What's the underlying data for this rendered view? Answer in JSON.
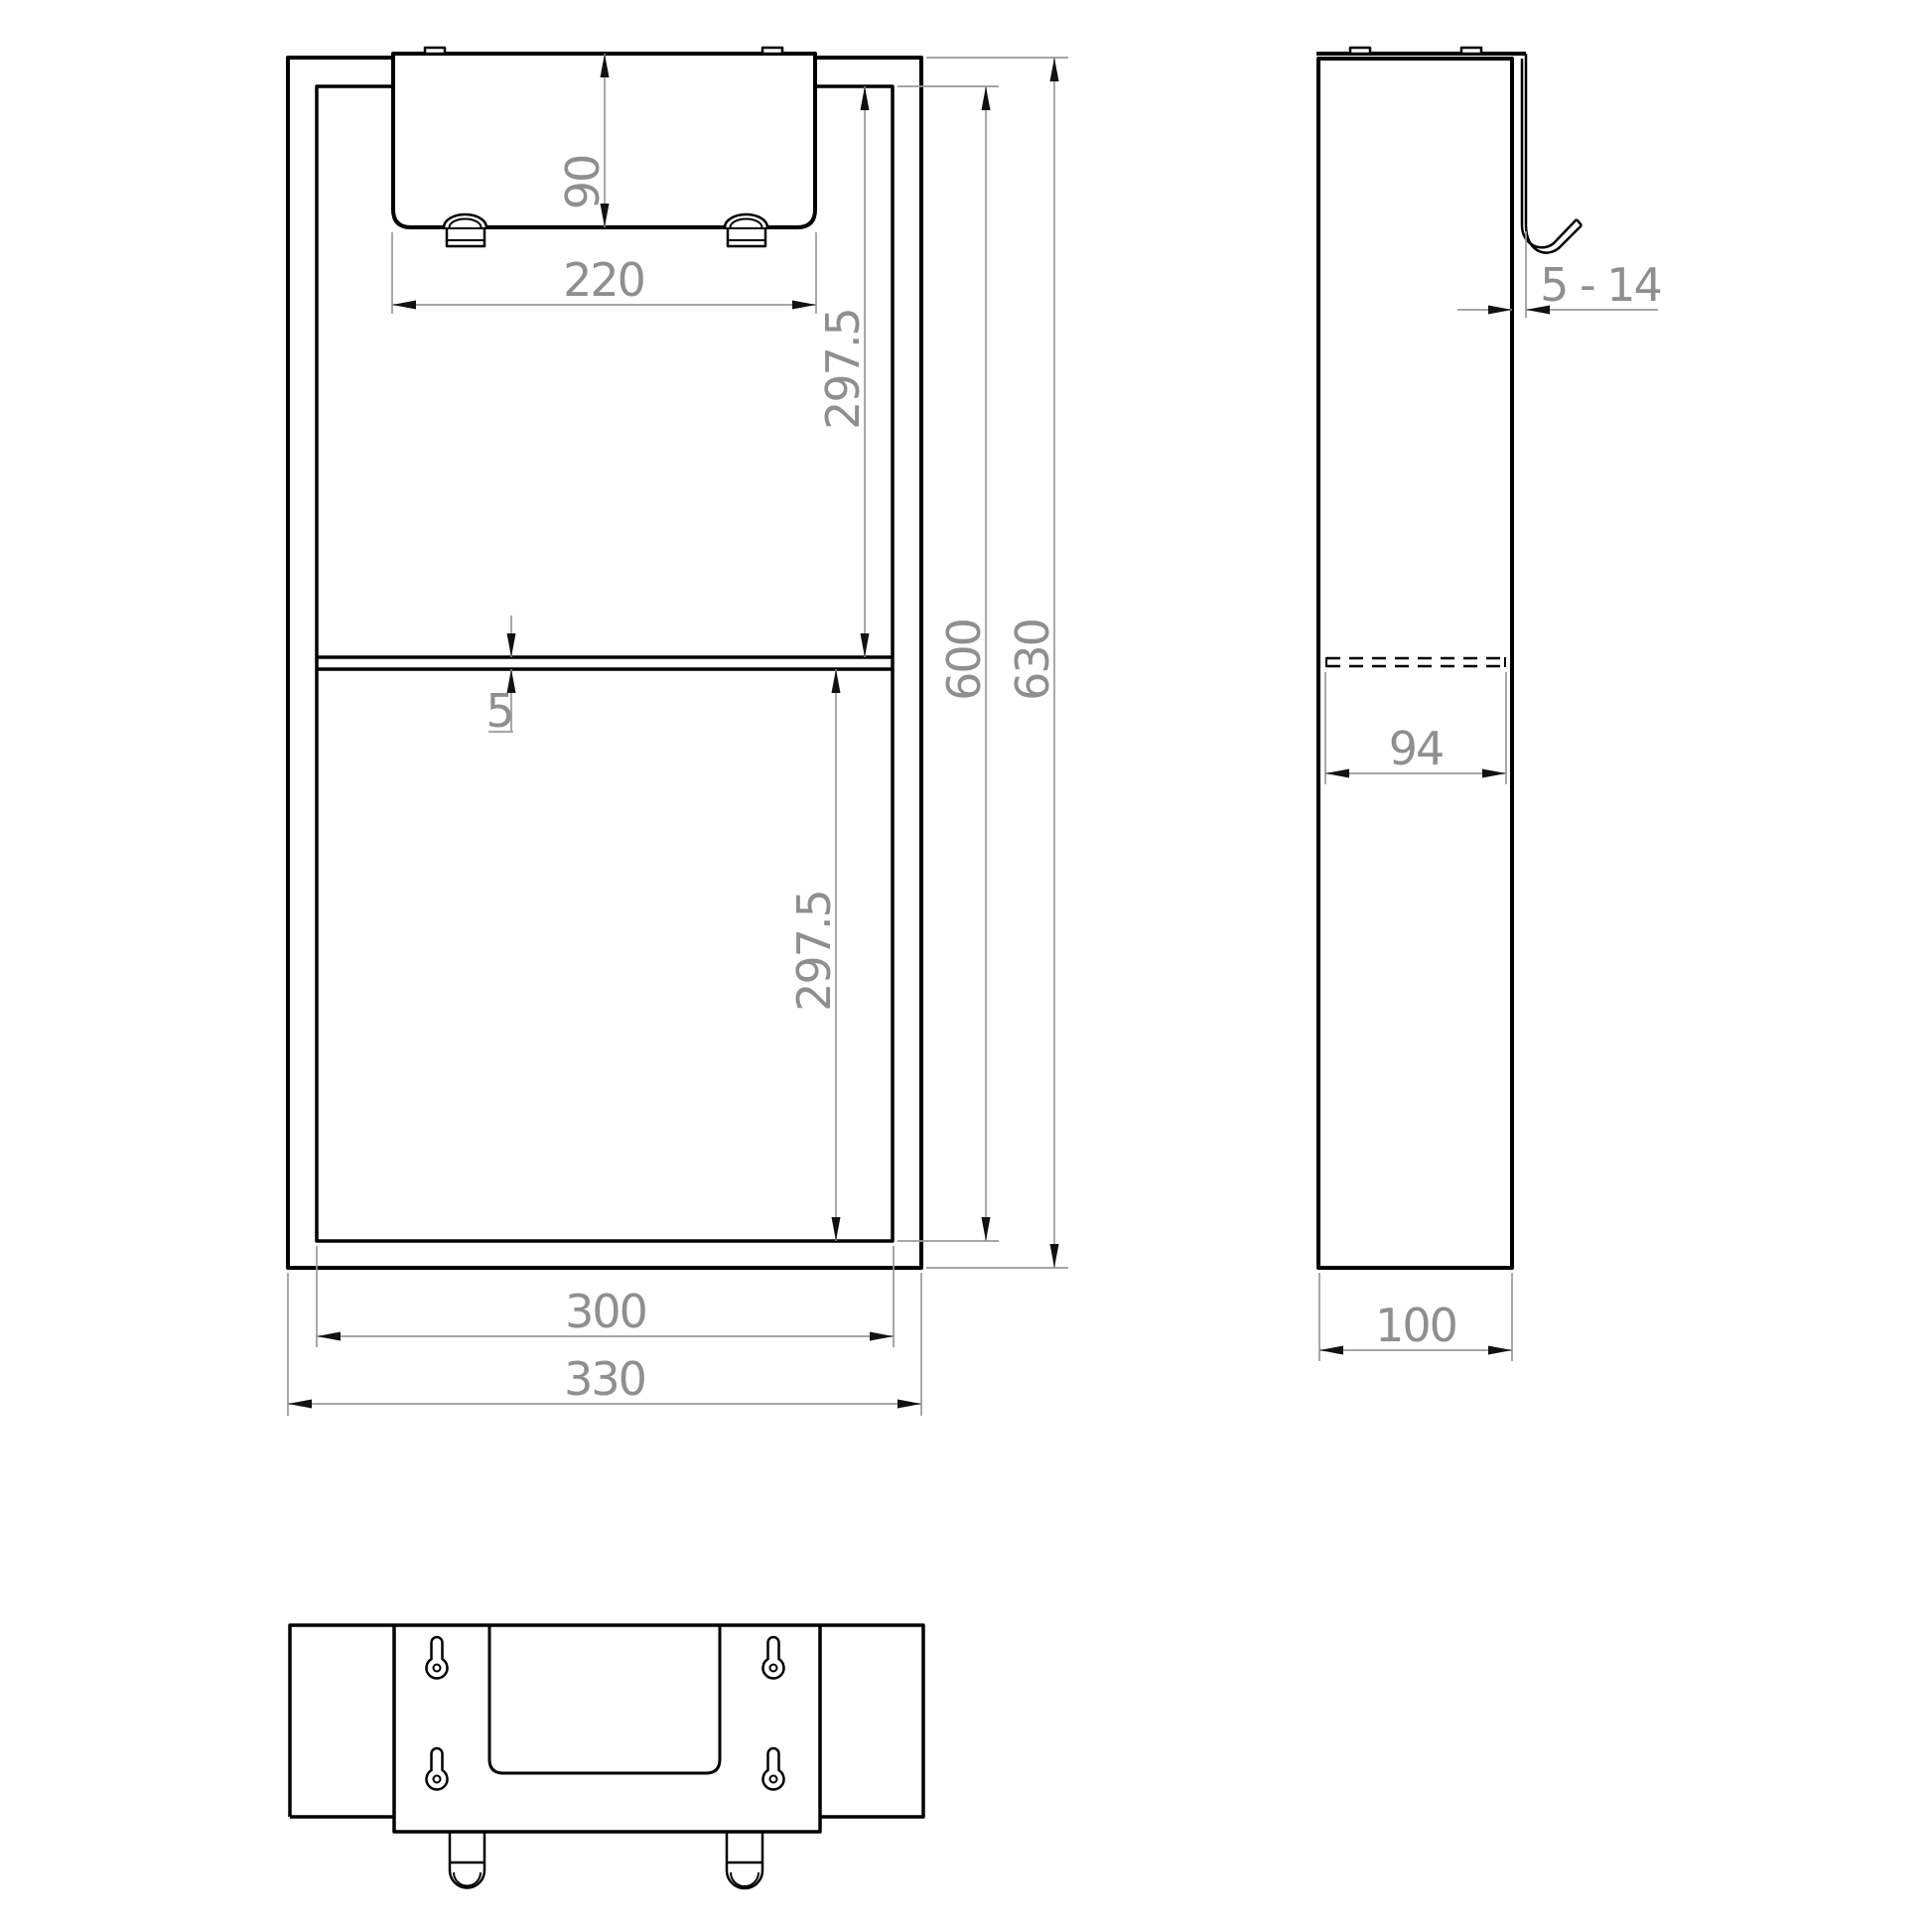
{
  "dimensions": {
    "front": {
      "flap_height": "90",
      "flap_width": "220",
      "upper_section_height": "297.5",
      "shelf_thickness": "5",
      "lower_section_height": "297.5",
      "inner_height": "600",
      "overall_height": "630",
      "inner_width": "300",
      "overall_width": "330"
    },
    "side": {
      "hook_gap_range": "5 - 14",
      "shelf_depth": "94",
      "overall_depth": "100"
    }
  },
  "style": {
    "background": "#ffffff",
    "object_line_color": "#000000",
    "dimension_line_color": "#9a9a9a",
    "dimension_text_color": "#8f8f8f",
    "arrowhead_color": "#111111"
  }
}
